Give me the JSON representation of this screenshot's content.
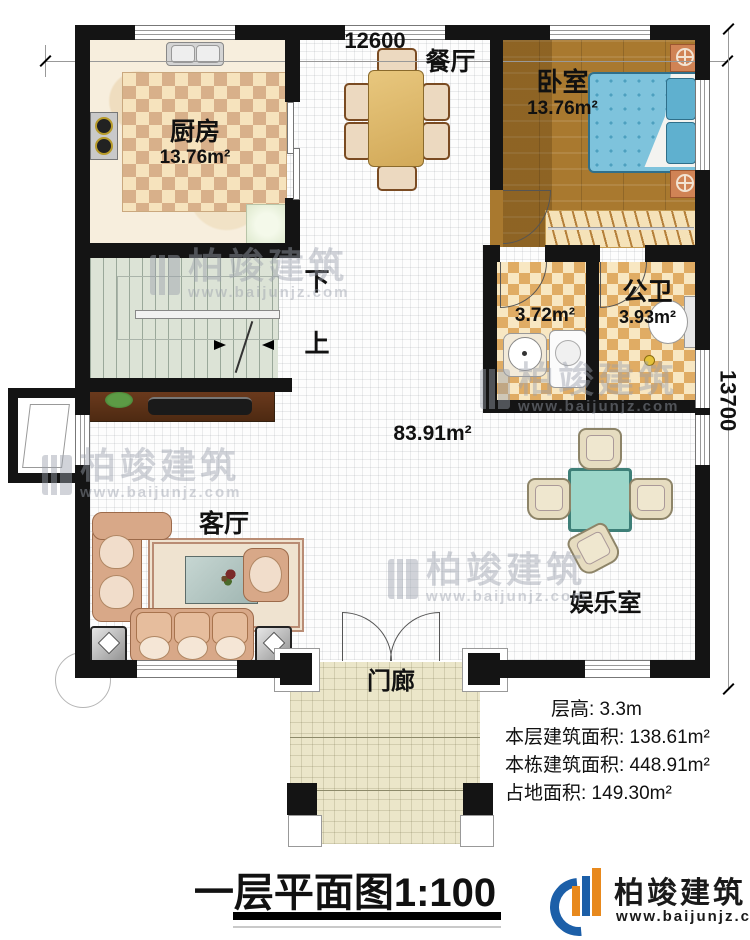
{
  "dimensions": {
    "width": "12600",
    "height": "13700"
  },
  "rooms": {
    "kitchen": {
      "name": "厨房",
      "area": "13.76m²"
    },
    "dining": {
      "name": "餐厅"
    },
    "bedroom": {
      "name": "卧室",
      "area": "13.76m²"
    },
    "bathroom": {
      "name": "公卫",
      "area": "3.93m²"
    },
    "laundry": {
      "area": "3.72m²"
    },
    "hall": {
      "area": "83.91m²"
    },
    "living": {
      "name": "客厅"
    },
    "entertainment": {
      "name": "娱乐室"
    },
    "porch": {
      "name": "门廊"
    },
    "stairs": {
      "down": "下",
      "up": "上"
    }
  },
  "stats": [
    {
      "text": "层高: 3.3m"
    },
    {
      "text": "本层建筑面积: 138.61m²"
    },
    {
      "text": "本栋建筑面积: 448.91m²"
    },
    {
      "text": "占地面积: 149.30m²"
    }
  ],
  "title": "一层平面图1:100",
  "logo": {
    "name": "柏竣建筑",
    "url": "www.baijunjz.com"
  },
  "watermark": {
    "name": "柏竣建筑",
    "url": "www.baijunjz.com"
  },
  "colors": {
    "wall": "#141414",
    "wood_floor": "#a9792f",
    "bath_tile": "#e0ac64",
    "kitchen_rug": "#d8b08a",
    "stair_floor": "#dce3d6",
    "porch_floor": "#ebe6c9",
    "bed": "#7ec3dc",
    "mahjong_table": "#9cd6c9",
    "logo_blue": "#1c5fa8",
    "logo_orange": "#e8891d"
  }
}
